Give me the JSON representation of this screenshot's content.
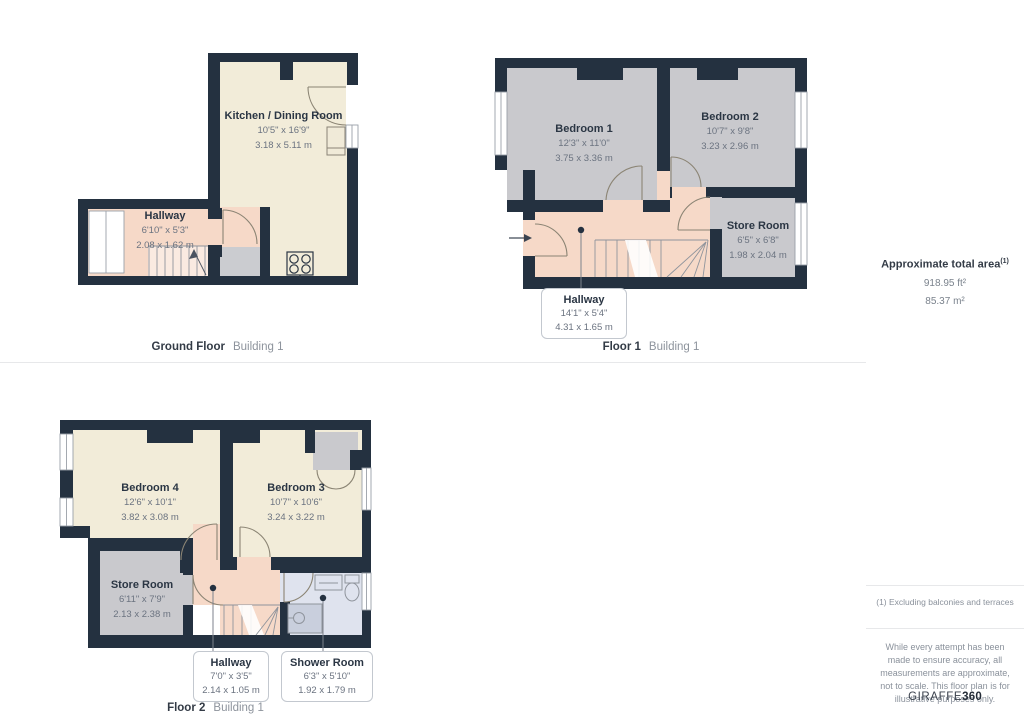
{
  "panels": {
    "ground_floor": {
      "floor_label": "Ground Floor",
      "building_label": "Building 1",
      "rooms": {
        "kitchen": {
          "name": "Kitchen / Dining Room",
          "dims_ft": "10'5\" x 16'9\"",
          "dims_m": "3.18 x 5.11 m"
        },
        "hallway": {
          "name": "Hallway",
          "dims_ft": "6'10\" x 5'3\"",
          "dims_m": "2.08 x 1.62 m"
        }
      }
    },
    "floor_1": {
      "floor_label": "Floor 1",
      "building_label": "Building 1",
      "rooms": {
        "bedroom_1": {
          "name": "Bedroom 1",
          "dims_ft": "12'3\" x 11'0\"",
          "dims_m": "3.75 x 3.36 m"
        },
        "bedroom_2": {
          "name": "Bedroom 2",
          "dims_ft": "10'7\" x 9'8\"",
          "dims_m": "3.23 x 2.96 m"
        },
        "store_room": {
          "name": "Store Room",
          "dims_ft": "6'5\" x 6'8\"",
          "dims_m": "1.98 x 2.04 m"
        },
        "hallway": {
          "name": "Hallway",
          "dims_ft": "14'1\" x 5'4\"",
          "dims_m": "4.31 x 1.65 m"
        }
      }
    },
    "floor_2": {
      "floor_label": "Floor 2",
      "building_label": "Building 1",
      "rooms": {
        "bedroom_4": {
          "name": "Bedroom 4",
          "dims_ft": "12'6\" x 10'1\"",
          "dims_m": "3.82 x 3.08 m"
        },
        "bedroom_3": {
          "name": "Bedroom 3",
          "dims_ft": "10'7\" x 10'6\"",
          "dims_m": "3.24 x 3.22 m"
        },
        "store_room": {
          "name": "Store Room",
          "dims_ft": "6'11\" x 7'9\"",
          "dims_m": "2.13 x 2.38 m"
        },
        "hallway": {
          "name": "Hallway",
          "dims_ft": "7'0\" x 3'5\"",
          "dims_m": "2.14 x 1.05 m"
        },
        "shower_room": {
          "name": "Shower Room",
          "dims_ft": "6'3\" x 5'10\"",
          "dims_m": "1.92 x 1.79 m"
        }
      }
    }
  },
  "sidebar": {
    "total_area_title": "Approximate total area",
    "total_area_superscript": "(1)",
    "total_area_ft": "918.95 ft²",
    "total_area_m": "85.37 m²",
    "footnote": "(1) Excluding balconies and terraces",
    "disclaimer": "While every attempt has been made to ensure accuracy, all measurements are approximate, not to scale. This floor plan is for illustrative purposes only.",
    "logo_text": "GIRAFFE",
    "logo_number": "360"
  },
  "colors": {
    "wall": "#243140",
    "room_cream": "#f2ecd9",
    "room_pink": "#f6d9c8",
    "room_gray": "#c9c9cd",
    "room_shower": "#dfe3ee",
    "fixture": "#c9cfdd",
    "door_stroke": "#8b8474",
    "label_dark": "#2b3644",
    "dim_gray": "#6b7380"
  }
}
